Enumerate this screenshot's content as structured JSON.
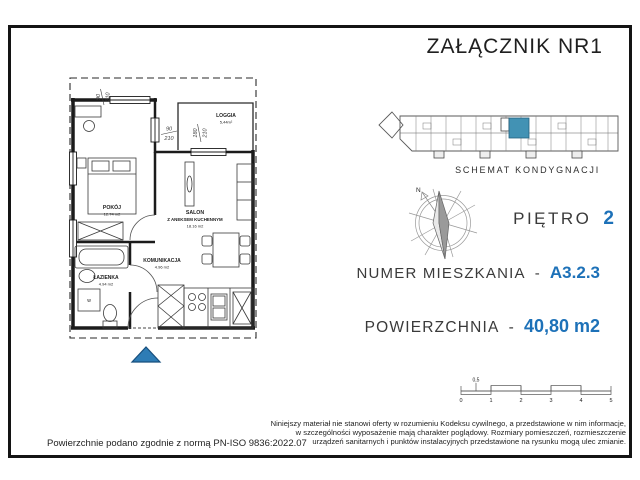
{
  "document": {
    "title": "ZAŁĄCZNIK NR1",
    "footer_note": "Powierzchnie podano zgodnie z normą PN-ISO 9836:2022.07",
    "disclaimer": {
      "line1": "Niniejszy materiał nie stanowi oferty w rozumieniu Kodeksu cywilnego, a przedstawione w nim informacje,",
      "line2": "w szczególności wyposażenie mają charakter poglądowy. Rozmiary pomieszczeń, rozmieszczenie",
      "line3": "urządzeń sanitarnych i punktów instalacyjnych przedstawione na rysunku mogą ulec zmianie."
    }
  },
  "floor_plan": {
    "rooms": {
      "pokoj": {
        "name": "POKÓJ",
        "area": "12.74 m2"
      },
      "salon": {
        "name": "SALON",
        "subname": "Z ANEKSEM KUCHENNYM",
        "area": "18.16 m2"
      },
      "komunikacja": {
        "name": "KOMUNIKACJA",
        "area": "4.96 m2"
      },
      "lazienka": {
        "name": "ŁAZIENKA",
        "area": "4.94 m2"
      },
      "loggia": {
        "name": "LOGGIA",
        "area": "5,44m²"
      }
    },
    "door_dimensions": {
      "top": {
        "w": "90",
        "h": "210"
      },
      "middle": {
        "w": "90",
        "h": "210"
      },
      "loggia": {
        "w": "180",
        "h": "210"
      }
    },
    "washer_label": "w",
    "compass_north": "N"
  },
  "summary": {
    "schematic_caption": "SCHEMAT KONDYGNACJI",
    "floor": {
      "label": "PIĘTRO",
      "value": "2"
    },
    "apartment": {
      "label": "NUMER MIESZKANIA",
      "sep": "-",
      "value": "A3.2.3"
    },
    "area": {
      "label": "POWIERZCHNIA",
      "sep": "-",
      "value": "40,80 m2"
    }
  },
  "scale_bar": {
    "ticks": [
      "0",
      "1",
      "2",
      "3",
      "4",
      "5"
    ],
    "half": "0,5"
  },
  "colors": {
    "accent": "#1d71b8",
    "highlight_unit": "#4292b4",
    "entrance_triangle": "#2e7cb5"
  }
}
